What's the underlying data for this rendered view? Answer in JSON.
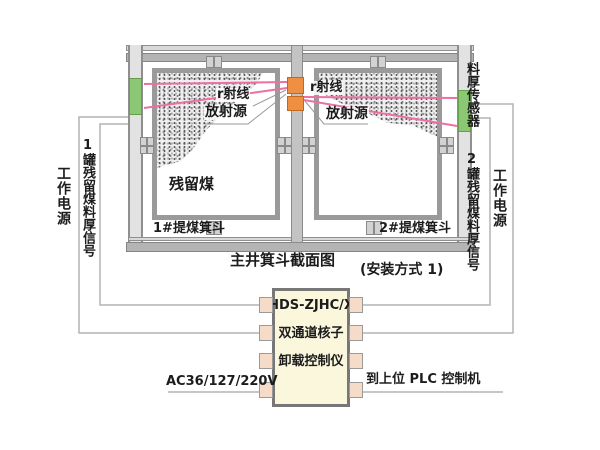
{
  "caption": {
    "main": "主井箕斗截面图",
    "note": "(安装方式 1)"
  },
  "hopper1": {
    "name": "1#提煤箕斗",
    "residual_coal": "残留煤",
    "ray": "r射线",
    "source": "放射源"
  },
  "hopper2": {
    "name": "2#提煤箕斗",
    "ray": "r射线",
    "source": "放射源"
  },
  "left_side": {
    "power": "工作电源",
    "signal": "1罐残留煤料厚信号"
  },
  "right_side": {
    "sensor": "料厚传感器",
    "signal": "2罐残留煤料厚信号",
    "power": "工作电源"
  },
  "controller": {
    "model": "HDS-ZJHC/X",
    "name_line1": "双通道核子",
    "name_line2": "卸载控制仪"
  },
  "connections": {
    "ac_power": "AC36/127/220V",
    "plc": "到上位 PLC 控制机"
  },
  "colors": {
    "sensor_green": "#8cc873",
    "source_orange": "#ef8f42",
    "beam_pink": "#ee6fa1",
    "structure_gray": "#b4b4b4",
    "wire_gray": "#b3b3b3",
    "controller_fill": "#fbf7dd",
    "pin_fill": "#f6dbc9"
  }
}
